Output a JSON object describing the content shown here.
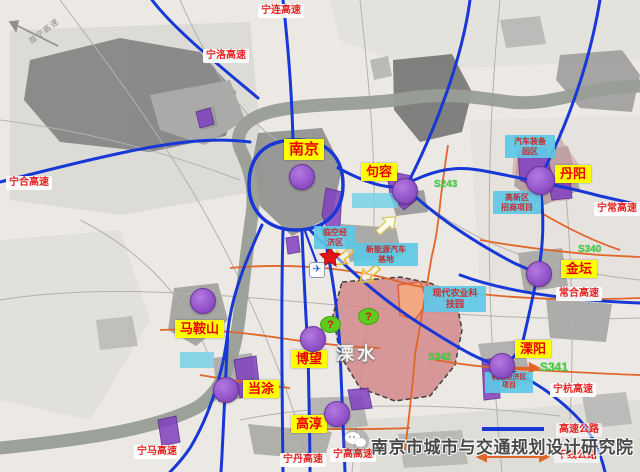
{
  "watermark": {
    "text": "南京市城市与交通规划设计研究院",
    "icon": "wechat-bubbles-icon"
  },
  "corner_direction_label": "滁宁高速",
  "district": {
    "name": "溧水"
  },
  "cities": [
    {
      "name": "南京"
    },
    {
      "name": "句容"
    },
    {
      "name": "丹阳"
    },
    {
      "name": "金坛"
    },
    {
      "name": "马鞍山"
    },
    {
      "name": "博望"
    },
    {
      "name": "当涂"
    },
    {
      "name": "高淳"
    },
    {
      "name": "溧阳"
    }
  ],
  "highway_labels": [
    {
      "name": "宁连高速"
    },
    {
      "name": "宁洛高速"
    },
    {
      "name": "宁合高速"
    },
    {
      "name": "宁常高速"
    },
    {
      "name": "常合高速"
    },
    {
      "name": "宁杭高速"
    },
    {
      "name": "宁马高速"
    },
    {
      "name": "宁丹高速"
    },
    {
      "name": "宁高高速"
    }
  ],
  "legend": {
    "expressway_label": "高速公路",
    "trunk_label": "干线公路"
  },
  "route_labels": [
    {
      "code": "S243"
    },
    {
      "code": "S340"
    },
    {
      "code": "S342"
    },
    {
      "code": "S341"
    }
  ],
  "project_labels": [
    {
      "line1": "临空经",
      "line2": "济区"
    },
    {
      "line1": "新能源汽车",
      "line2": "基地"
    },
    {
      "line1": "汽车装备",
      "line2": "园区"
    },
    {
      "line1": "高新区",
      "line2": "招商项目"
    },
    {
      "line1": "现代农业科",
      "line2": "技园"
    },
    {
      "line1": "机场经济区",
      "line2": "项目"
    }
  ],
  "markers": {
    "question_mark": "?",
    "airport_icon": "✈"
  },
  "colors": {
    "expressway_blue": "#1838d6",
    "trunk_orange": "#e0662a",
    "city_label_bg": "#ffff00",
    "city_label_text": "#ee0000",
    "highway_label_text": "#e62222",
    "project_box_bg": "#5ec8e6",
    "project_box_text": "#c03030",
    "route_green": "#3fd43f",
    "marker_purple": "#9152c8",
    "district_pink": "#d4898d"
  }
}
